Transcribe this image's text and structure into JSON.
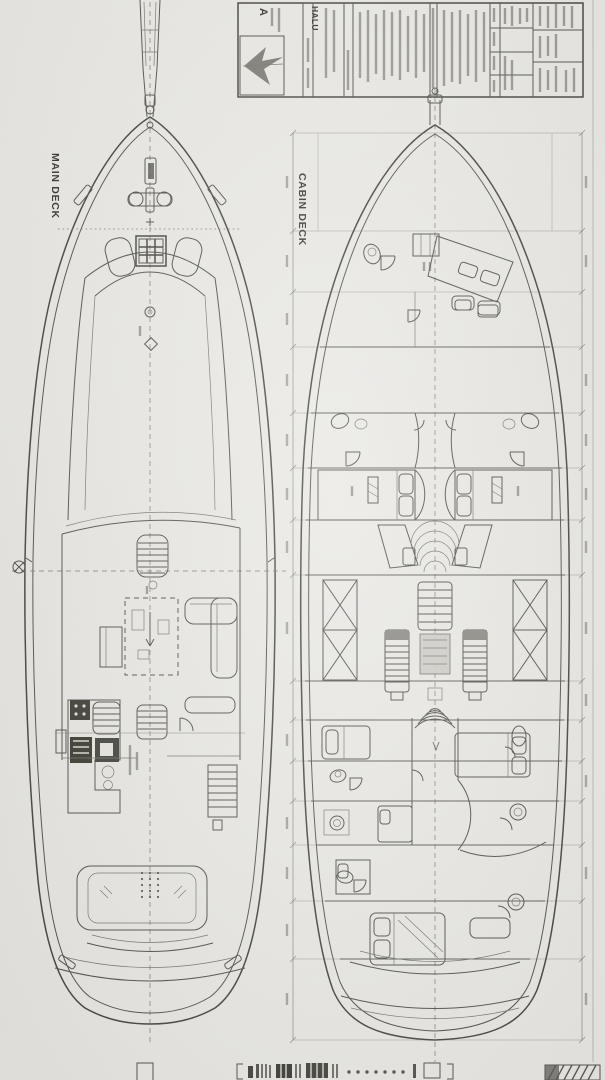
{
  "page": {
    "paper_color": "#e9e8e4",
    "ink_color": "#4b4b47",
    "description_colors": {
      "dark_fixture": "#3c3c39",
      "mid_tone": "#8a8983"
    }
  },
  "main_deck": {
    "label": "MAIN DECK"
  },
  "cabin_deck": {
    "label": "CABIN DECK"
  },
  "title_block": {
    "vessel_name": "HALU",
    "logo_letter": "A"
  }
}
